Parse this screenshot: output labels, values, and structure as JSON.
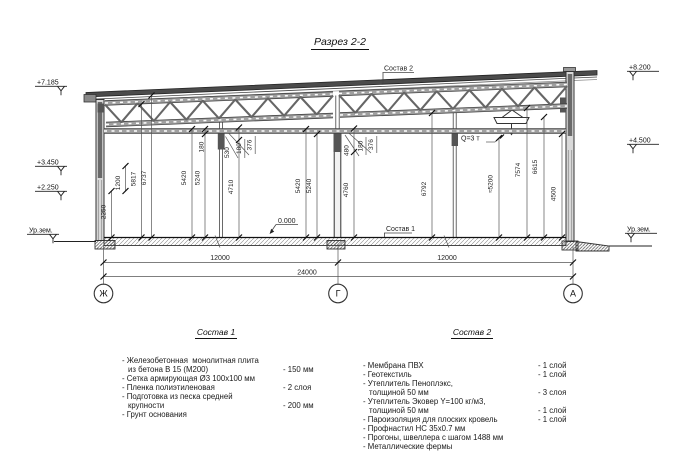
{
  "title": "Разрез 2-2",
  "drawing": {
    "callout_sostav2": "Состав 2",
    "callout_sostav1": "Состав 1",
    "crane_label": "Q=3 т",
    "zero_level": "0.000",
    "elev_left": {
      "e1": "+7.185",
      "e2": "+3.450",
      "e3": "+2.250",
      "ground": "Ур.зем."
    },
    "elev_right": {
      "e1": "+8.200",
      "e2": "+4.500",
      "ground": "Ур.зем."
    },
    "vdims": {
      "d2250": "2250",
      "d1200": "1200",
      "d5817": "5817",
      "d6737": "6737",
      "d5420a": "5420",
      "d5240a": "5240",
      "d180a": "180",
      "d4710": "4710",
      "d530": "530",
      "c180a": "180",
      "c376a": "376",
      "d5420b": "5420",
      "d5240b": "5240",
      "d480": "480",
      "d4760": "4760",
      "d180b": "180",
      "c376b": "376",
      "d6792": "6792",
      "d5200": "≈5200",
      "d7574": "7574",
      "d6615": "6615",
      "d4500": "4500"
    },
    "hdims": {
      "left": "12000",
      "right": "12000",
      "total": "24000"
    },
    "axes": {
      "a1": "Ж",
      "a2": "Г",
      "a3": "А"
    }
  },
  "sostav1": {
    "header": "Состав 1",
    "rows": [
      {
        "t": "- Железобетонная  монолитная плита",
        "v": ""
      },
      {
        "t": "из бетона В 15 (М200)",
        "v": "- 150 мм"
      },
      {
        "t": "- Сетка армирующая Ø3 100х100 мм",
        "v": ""
      },
      {
        "t": "- Пленка полиэтиленовая",
        "v": "- 2 слоя"
      },
      {
        "t": "- Подготовка из песка средней",
        "v": ""
      },
      {
        "t": "крупности",
        "v": "- 200 мм"
      },
      {
        "t": "- Грунт основания",
        "v": ""
      }
    ]
  },
  "sostav2": {
    "header": "Состав 2",
    "rows": [
      {
        "t": "- Мембрана ПВХ",
        "v": "- 1 слой"
      },
      {
        "t": "- Геотекстиль",
        "v": "- 1 слой"
      },
      {
        "t": "- Утеплитель Пеноплэкс,",
        "v": ""
      },
      {
        "t": "толщиной 50 мм",
        "v": "- 3 слоя"
      },
      {
        "t": "- Утеплитель Эковер Y=100 кг/м3,",
        "v": ""
      },
      {
        "t": "толщиной 50 мм",
        "v": "- 1 слой"
      },
      {
        "t": "- Пароизоляция для плоских кровель",
        "v": "- 1 слой"
      },
      {
        "t": "- Профнастил НС 35х0.7 мм",
        "v": ""
      },
      {
        "t": "- Прогоны, швеллера с шагом 1488 мм",
        "v": ""
      },
      {
        "t": "- Металлические фермы",
        "v": ""
      }
    ]
  }
}
